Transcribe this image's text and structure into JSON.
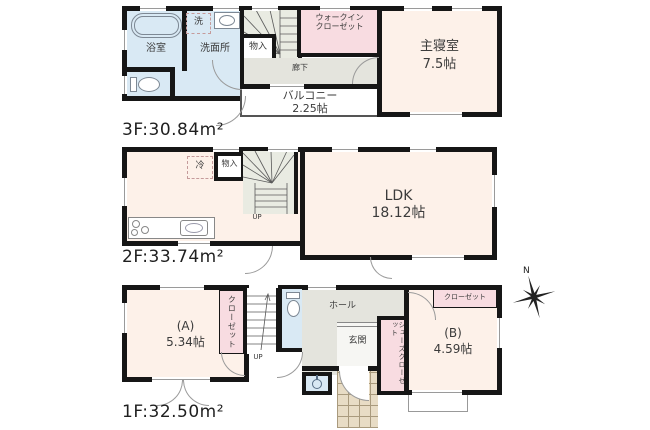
{
  "plan_title": "3-story house floor plan",
  "f3": {
    "bath": "浴室",
    "laundry": "洗",
    "washroom": "洗面所",
    "storage": "物入",
    "corridor": "廊下",
    "wic_line1": "ウォークイン",
    "wic_line2": "クローゼット",
    "bedroom": "主寝室",
    "bedroom_size": "7.5帖",
    "balcony": "バルコニー",
    "balcony_size": "2.25帖",
    "area": "3F:30.84m²"
  },
  "f2": {
    "fridge": "冷",
    "storage": "物入",
    "up": "UP",
    "ldk": "LDK",
    "ldk_size": "18.12帖",
    "area": "2F:33.74m²"
  },
  "f1": {
    "room_a": "(A)",
    "room_a_size": "5.34帖",
    "closet_a": "クローゼット",
    "up": "UP",
    "hall": "ホール",
    "entrance": "玄関",
    "shoes_closet": "シューズクローゼット",
    "room_b": "(B)",
    "room_b_size": "4.59帖",
    "closet_b": "クローゼット",
    "area": "1F:32.50m²"
  },
  "compass": {
    "north": "N"
  },
  "palette": {
    "wall": "#161616",
    "room_cream": "#fdf1e9",
    "wet_blue": "#d9e9f4",
    "closet_pink": "#f8dce1",
    "hall_gray": "#e4e4dd",
    "stair_gray": "#e9ebe2",
    "porch_tan": "#e8dcc5"
  }
}
